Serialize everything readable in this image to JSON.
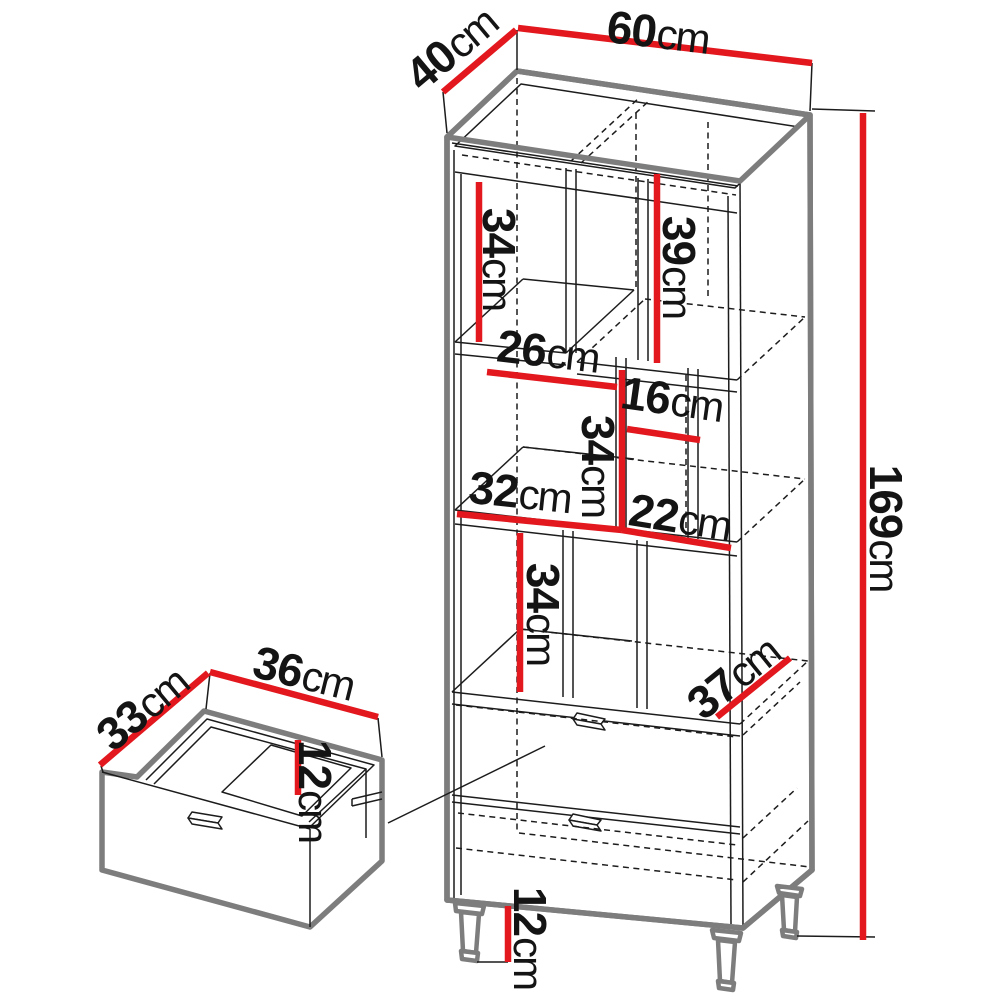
{
  "diagram": {
    "title": "furniture-dimension-diagram",
    "dims": {
      "width_top": {
        "value": "60",
        "unit": "cm"
      },
      "depth_top": {
        "value": "40",
        "unit": "cm"
      },
      "height_total": {
        "value": "169",
        "unit": "cm"
      },
      "upper_left_height": {
        "value": "34",
        "unit": "cm"
      },
      "upper_right_height": {
        "value": "39",
        "unit": "cm"
      },
      "mid_left_width": {
        "value": "26",
        "unit": "cm"
      },
      "mid_right_width": {
        "value": "16",
        "unit": "cm"
      },
      "mid_height": {
        "value": "34",
        "unit": "cm"
      },
      "lower_left_width": {
        "value": "32",
        "unit": "cm"
      },
      "lower_right_width": {
        "value": "22",
        "unit": "cm"
      },
      "lower_height": {
        "value": "34",
        "unit": "cm"
      },
      "bottom_depth": {
        "value": "37",
        "unit": "cm"
      },
      "leg_height": {
        "value": "12",
        "unit": "cm"
      },
      "drawer_width": {
        "value": "36",
        "unit": "cm"
      },
      "drawer_depth": {
        "value": "33",
        "unit": "cm"
      },
      "drawer_height": {
        "value": "12",
        "unit": "cm"
      }
    },
    "colors": {
      "dimension_line": "#e2181e",
      "outer_outline": "#7d7d7d",
      "detail_line": "#1c1c1c",
      "background": "#ffffff"
    }
  }
}
